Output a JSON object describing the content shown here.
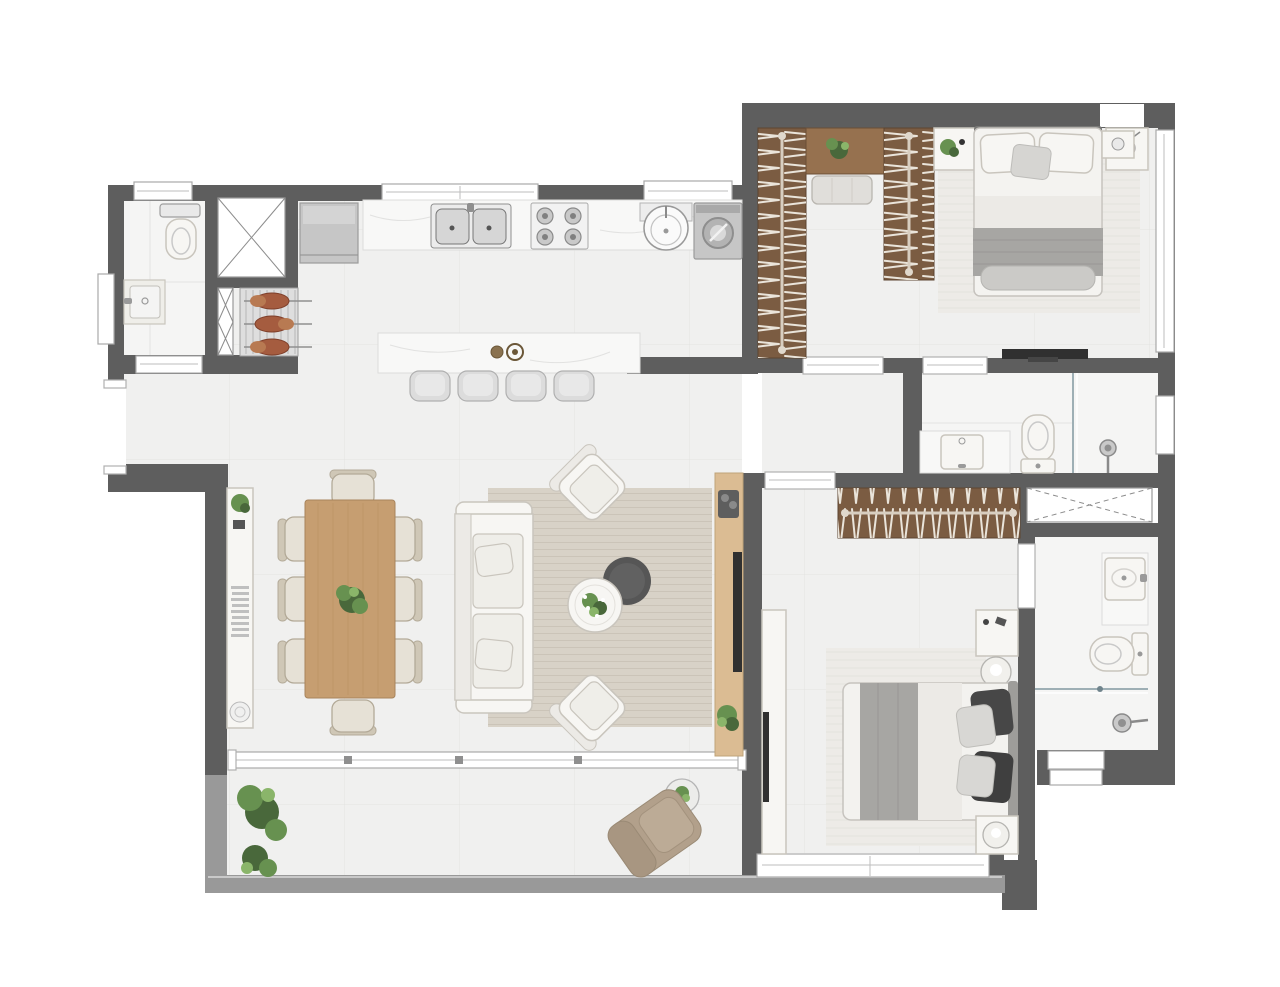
{
  "plan": {
    "type": "apartment-floor-plan",
    "view": "top-down-furnished-render",
    "visible_text": "",
    "rooms": [
      {
        "name": "service-bathroom",
        "furniture": [
          "toilet",
          "wall-vanity-sink",
          "window",
          "door-opening"
        ]
      },
      {
        "name": "elevator-shaft",
        "furniture": [
          "x-marked-shaft"
        ]
      },
      {
        "name": "barbecue-area",
        "furniture": [
          "grill-rack",
          "skewers-with-meat",
          "x-marked-duct-strip"
        ]
      },
      {
        "name": "kitchen",
        "furniture": [
          "straight-counter",
          "double-basin-sink",
          "cooktop-4-burners",
          "refrigerator",
          "island-bar-counter",
          "bar-faucets",
          "bar-stools",
          "window"
        ]
      },
      {
        "name": "laundry-area",
        "furniture": [
          "round-wash-tank",
          "washing-machine",
          "window"
        ]
      },
      {
        "name": "entry-hall",
        "furniture": [
          "entrance-opening"
        ]
      },
      {
        "name": "dining-room",
        "furniture": [
          "rectangular-wood-table",
          "dining-chairs",
          "plant-centerpiece",
          "slim-console-sideboard",
          "decor-books",
          "decor-bowl",
          "decor-plant"
        ]
      },
      {
        "name": "living-room",
        "furniture": [
          "three-seat-sofa",
          "accent-armchairs",
          "round-marble-coffee-table",
          "round-dark-side-table",
          "area-rug",
          "tv-wood-panel",
          "tv",
          "soundbar",
          "floor-plant"
        ]
      },
      {
        "name": "balcony",
        "furniture": [
          "sliding-glass-door",
          "large-planter-plants",
          "lounge-chair",
          "round-side-table-with-plant",
          "parapet-railing"
        ]
      },
      {
        "name": "bedroom-1",
        "furniture": [
          "open-wardrobe-column-left",
          "open-wardrobe-column-right",
          "wardrobe-bridge-shelf-with-plant",
          "bench-ottoman",
          "double-bed",
          "pillows",
          "throw-blanket",
          "nightstand-with-plant",
          "nightstand-with-lamp",
          "area-rug",
          "wall-tv",
          "corner-fixture",
          "window"
        ]
      },
      {
        "name": "bathroom-1-ensuite",
        "furniture": [
          "marble-vanity-sink",
          "toilet",
          "glass-shower-partition",
          "shower-head",
          "window",
          "door-opening"
        ]
      },
      {
        "name": "bedroom-2",
        "furniture": [
          "open-closet-rail",
          "double-bed",
          "dark-pillows",
          "light-pillows",
          "throw-blanket",
          "nightstand-with-sphere-lamp-top",
          "nightstand-with-sphere-lamp-bottom",
          "area-rug",
          "dresser-tv-cabinet",
          "tv",
          "window"
        ]
      },
      {
        "name": "bathroom-2",
        "furniture": [
          "marble-vanity-sink",
          "toilet",
          "glass-shower-partition",
          "shower-head",
          "window",
          "door-opening"
        ]
      },
      {
        "name": "bathroom-shaft",
        "furniture": [
          "x-marked-duct"
        ]
      }
    ],
    "counts": {
      "bedrooms": 2,
      "bathrooms": 3,
      "dining_chairs": 8,
      "bar_stools": 4,
      "bbq_skewers": 3,
      "sliding_door_panels": 4,
      "wardrobe_columns": 2,
      "balcony_planters": 2
    }
  },
  "palette": {
    "wall": "#5e5e5e",
    "parapet": "#999999",
    "floor": "#f0f0ef",
    "floor_bright": "#f5f5f4",
    "tile_line": "#e3e3e2",
    "marble": "#f8f8f7",
    "marble_line": "#dcdcdb",
    "wood_dark": "#7b5c42",
    "wood_mid": "#96714f",
    "wood_table": "#c69e71",
    "wood_panel": "#dbbc93",
    "white_furn": "#f7f6f3",
    "furn_line": "#c9c5bd",
    "gray_fabric": "#a7a6a3",
    "dark_fabric": "#474747",
    "rug": "#d8d2c7",
    "rug_line": "#cbc4b8",
    "rug_light": "#edebe7",
    "appliance": "#c6c6c6",
    "plant": "#679150",
    "plant_dark": "#49683b",
    "tan": "#b2a08b",
    "glass_line": "#8fa3ab",
    "tv_dark": "#303030"
  }
}
